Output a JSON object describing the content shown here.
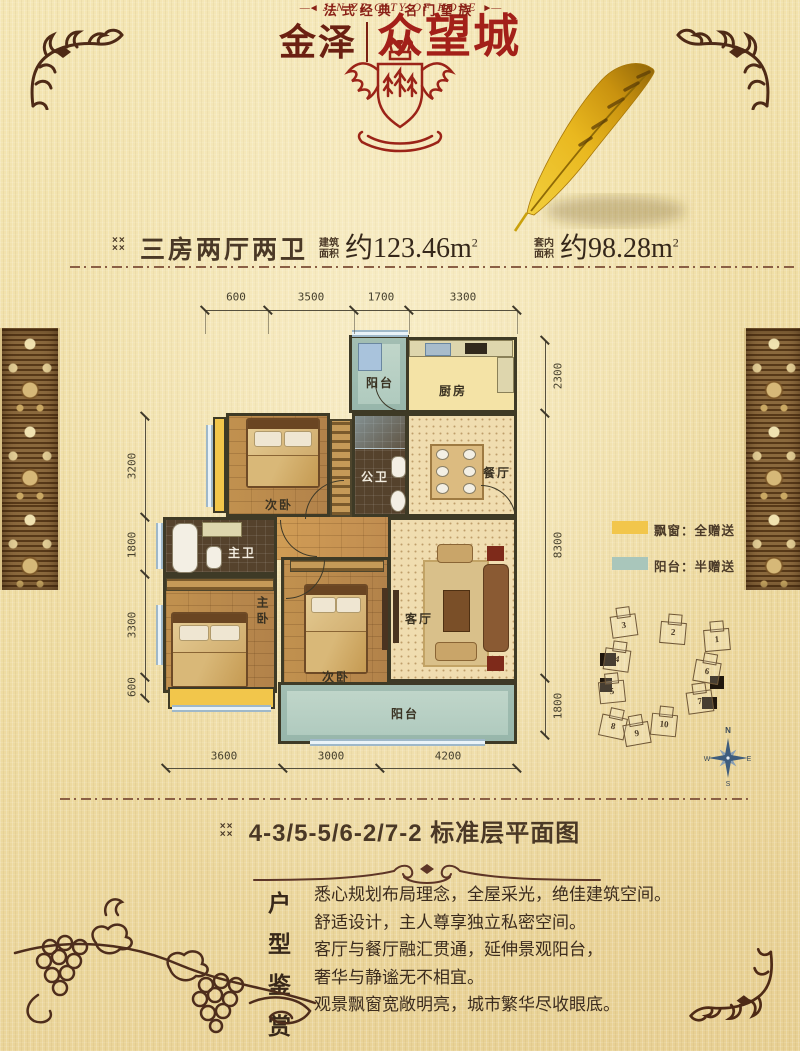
{
  "brand": {
    "name_left": "金泽",
    "name_right": "众望城",
    "english": "JIN ZE CITY OF HOPE",
    "english_prefix": "―◄",
    "english_suffix": "►―",
    "tagline": "法式经典  名门望族"
  },
  "header": {
    "marker": "××××",
    "unit_type": "三房两厅两卫",
    "gross_label_top": "建筑",
    "gross_label_bottom": "面积",
    "gross_value": "约123.46m",
    "inner_label_top": "套内",
    "inner_label_bottom": "面积",
    "inner_value": "约98.28m",
    "sup": "2"
  },
  "plan": {
    "rooms": {
      "balcony_top": "阳台",
      "kitchen": "厨房",
      "bedroom_top": "次卧",
      "bath_public": "公卫",
      "dining": "餐厅",
      "bath_master": "主卫",
      "bedroom_master": "主卧",
      "bedroom_second": "次卧",
      "living": "客厅",
      "balcony_bottom": "阳台"
    },
    "dims": {
      "top": [
        "600",
        "3500",
        "1700",
        "3300"
      ],
      "bottom": [
        "3600",
        "3000",
        "4200"
      ],
      "left": [
        "3200",
        "1800",
        "3300",
        "600"
      ],
      "right": [
        "2300",
        "8300",
        "1800"
      ]
    }
  },
  "legend": {
    "items": [
      {
        "label": "飘窗：全赠送",
        "color": "#f2c64b"
      },
      {
        "label": "阳台：半赠送",
        "color": "#a9c6bb"
      }
    ]
  },
  "siteplan": {
    "buildings": [
      "1",
      "2",
      "3",
      "4",
      "5",
      "6",
      "7",
      "8",
      "9",
      "10"
    ],
    "compass": {
      "n": "N",
      "e": "E",
      "s": "S",
      "w": "W"
    }
  },
  "footer": {
    "marker": "××××",
    "plan_title": "4-3/5-5/6-2/7-2 标准层平面图",
    "section_heading": [
      "户",
      "型",
      "鉴",
      "赏"
    ],
    "lines": [
      "悉心规划布局理念，全屋采光，绝佳建筑空间。",
      "舒适设计，主人尊享独立私密空间。",
      "客厅与餐厅融汇贯通，延伸景观阳台，",
      "奢华与静谧无不相宜。",
      "观景飘窗宽敞明亮，城市繁华尽收眼底。"
    ]
  },
  "colors": {
    "brand_red": "#a32019",
    "brand_dark_red": "#6b2012",
    "text_brown": "#4a3826",
    "bay_yellow": "#f2c64b",
    "balcony_teal": "#a9c6bb"
  }
}
